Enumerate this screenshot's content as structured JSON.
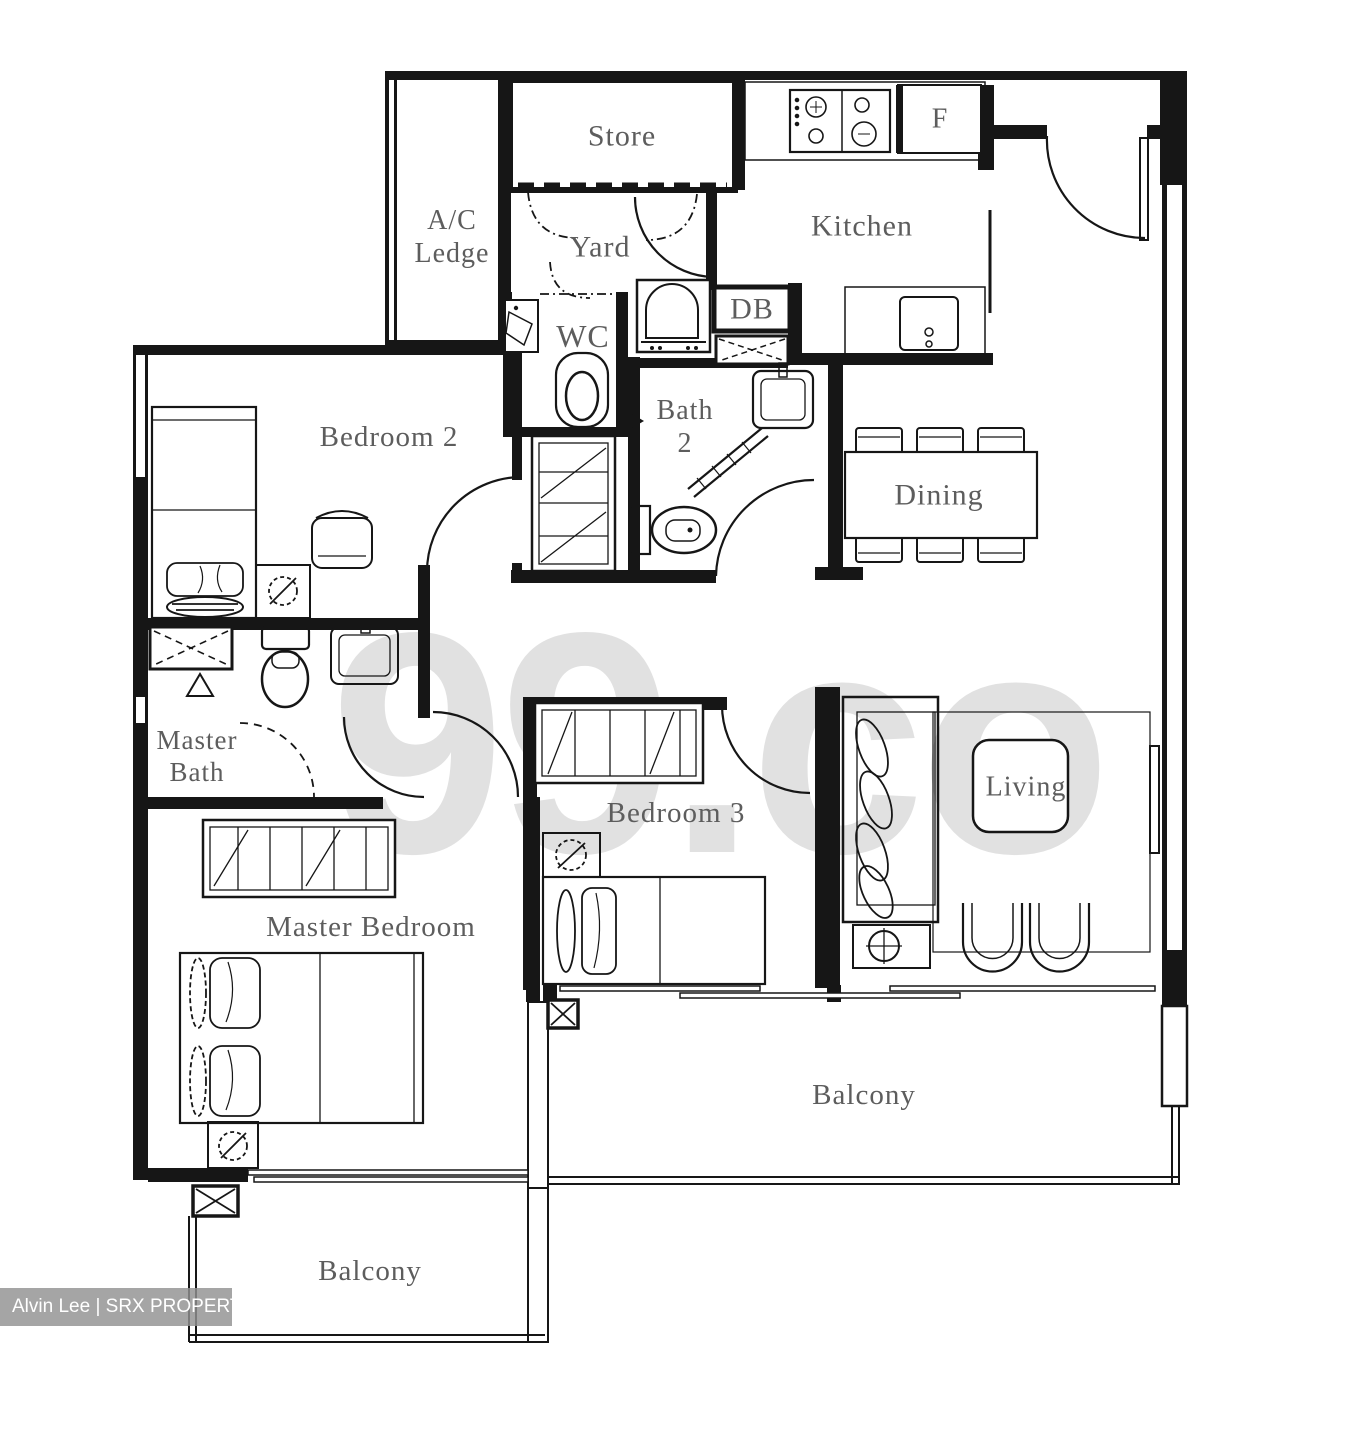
{
  "plan": {
    "title": "3-bedroom apartment floor plan",
    "watermark": "99.co",
    "credit": "Alvin Lee | SRX PROPERTY",
    "colors": {
      "wall": "#161616",
      "label_text": "#5d5d5d",
      "watermark_gray": "#c9c9c9",
      "credit_bg": "#919191",
      "credit_text": "#ffffff",
      "background": "#ffffff"
    },
    "rooms": {
      "store": {
        "label": "Store"
      },
      "ac_ledge": {
        "label": "A/C\nLedge"
      },
      "yard": {
        "label": "Yard"
      },
      "kitchen": {
        "label": "Kitchen"
      },
      "fridge": {
        "label": "F"
      },
      "wc": {
        "label": "WC"
      },
      "db": {
        "label": "DB"
      },
      "bath2": {
        "label": "Bath\n2"
      },
      "bedroom2": {
        "label": "Bedroom 2"
      },
      "dining": {
        "label": "Dining"
      },
      "master_bath": {
        "label": "Master\nBath"
      },
      "bedroom3": {
        "label": "Bedroom 3"
      },
      "living": {
        "label": "Living"
      },
      "master_bedroom": {
        "label": "Master Bedroom"
      },
      "balcony_main": {
        "label": "Balcony"
      },
      "balcony_master": {
        "label": "Balcony"
      }
    },
    "icons": [
      "stove-icon",
      "fridge-compartment",
      "sink-icon",
      "washing-machine-icon",
      "toilet-icon",
      "shower-icon",
      "wardrobe-icon",
      "bed-icon",
      "lamp-icon",
      "dining-table-icon",
      "sofa-icon",
      "coffee-table-icon",
      "tv-icon",
      "column-icon"
    ]
  }
}
